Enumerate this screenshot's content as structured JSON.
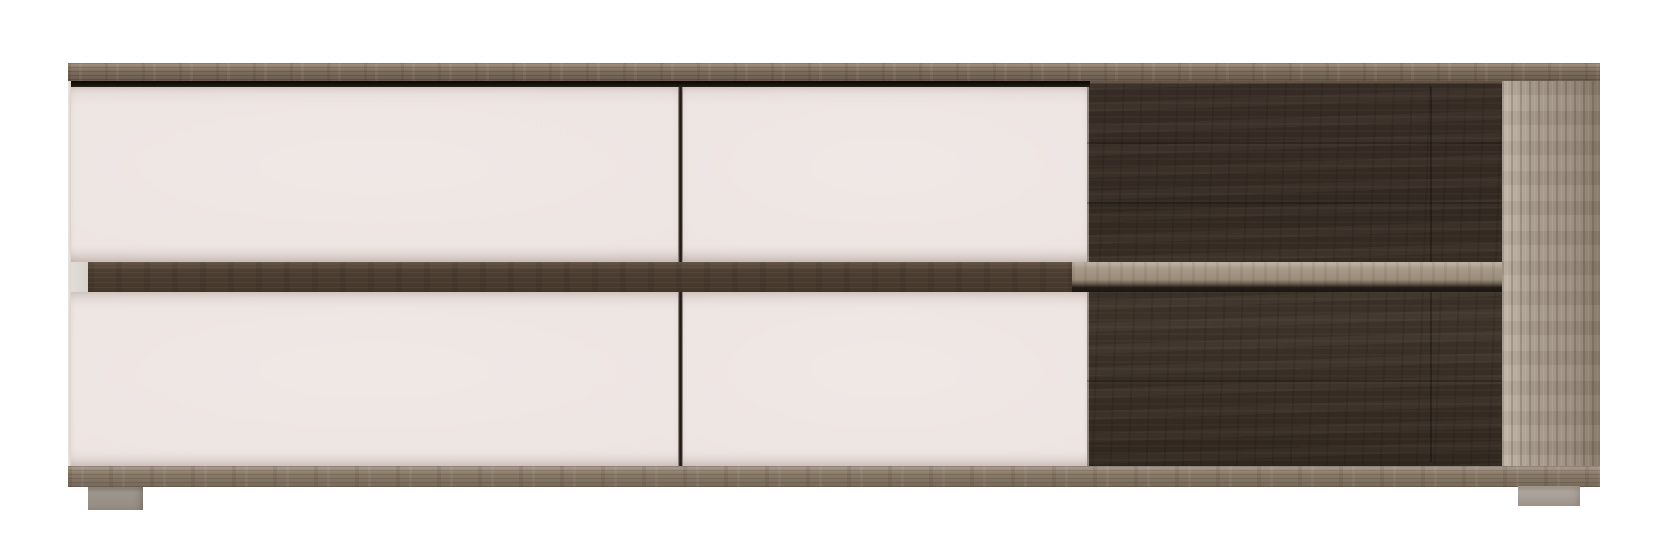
{
  "scene": {
    "type": "product-photo",
    "subject": "low tv-stand sideboard with four white handleless drawer fronts, an open dark-oak shelf compartment on the right, truffle-oak top board, plinth and side panel, standing on two small grey feet against a plain white background",
    "background_color": "#ffffff"
  },
  "palette": {
    "bg": "#ffffff",
    "drawer_front": "#ede4e1",
    "drawer_front_edge": "#e2d7d3",
    "top_board_light": "#a3927f",
    "top_board": "#7e6e5e",
    "top_board_dark": "#695a4c",
    "gap_line": "#16100c",
    "divider_line": "#241b14",
    "carcass_sliver": "#d8d2cc",
    "band_dark": "#4c3e32",
    "band_dark_light": "#5f5042",
    "shelf_light": "#a99b8a",
    "shelf_shadow": "#241d17",
    "interior_dark": "#352b23",
    "interior_mid": "#40352b",
    "side_panel": "#a89b8d",
    "side_panel_light": "#beb2a4",
    "side_panel_dark": "#857767",
    "bottom_board": "#8b7c6b",
    "bottom_board_dark": "#77695a",
    "foot_left": "#9e958d",
    "foot_right": "#ada49c"
  }
}
